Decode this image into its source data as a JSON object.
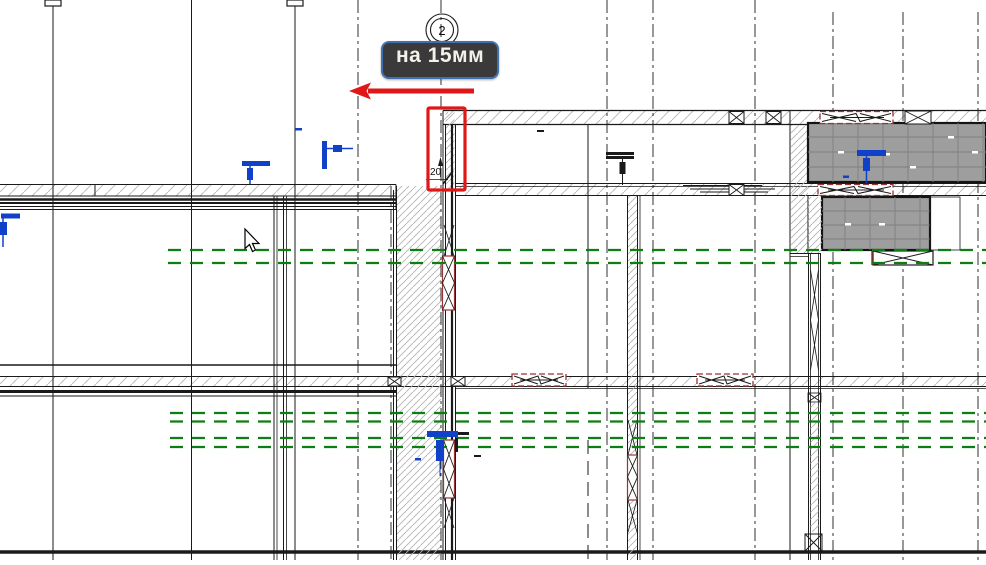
{
  "view": {
    "type": "cad-floor-plan",
    "background": "#ffffff"
  },
  "tooltip": {
    "text": "на 15мм"
  },
  "dimension": {
    "value": "20"
  },
  "grid": {
    "bubble_label": "2"
  },
  "colors": {
    "background": "#ffffff",
    "ink": "#1a1a1a",
    "selection_red": "#e01717",
    "hidden_green": "#0e7d12",
    "symbol_blue": "#1140c9",
    "beam_red": "#9a3333",
    "slab_gray": "#9e9e9e",
    "slab_grid": "#7f7f7f",
    "hatch": "#b3b3b3",
    "tooltip_bg": "#3a3a3a",
    "tooltip_border": "#3e70b2",
    "tooltip_text": "#f5f1ea"
  }
}
